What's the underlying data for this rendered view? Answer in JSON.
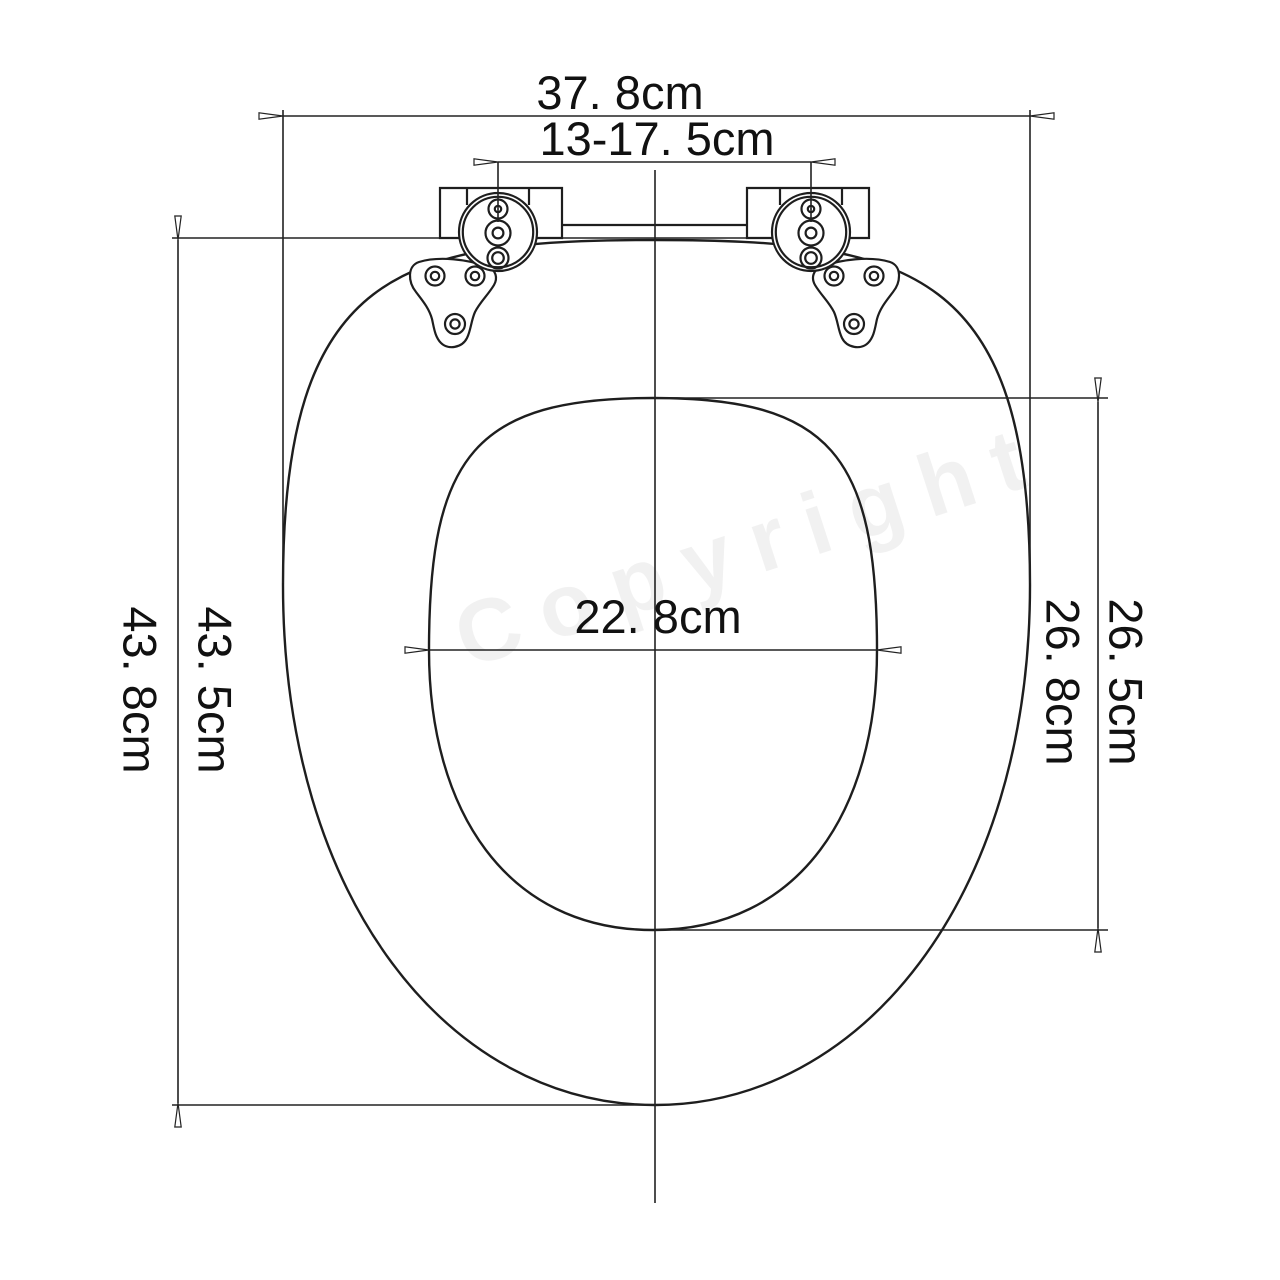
{
  "diagram": {
    "type": "technical-drawing",
    "subject": "Toilet seat top view with dimension callouts",
    "background_color": "#ffffff",
    "line_color": "#1e1e1e",
    "watermark": "Copyright",
    "dims": {
      "overall_width": "37. 8cm",
      "hinge_hole_spacing": "13-17. 5cm",
      "inner_width": "22. 8cm",
      "seat_length": "43. 5cm",
      "total_length": "43. 8cm",
      "inner_length": "26. 5cm",
      "inner_length_outer": "26. 8cm"
    }
  }
}
